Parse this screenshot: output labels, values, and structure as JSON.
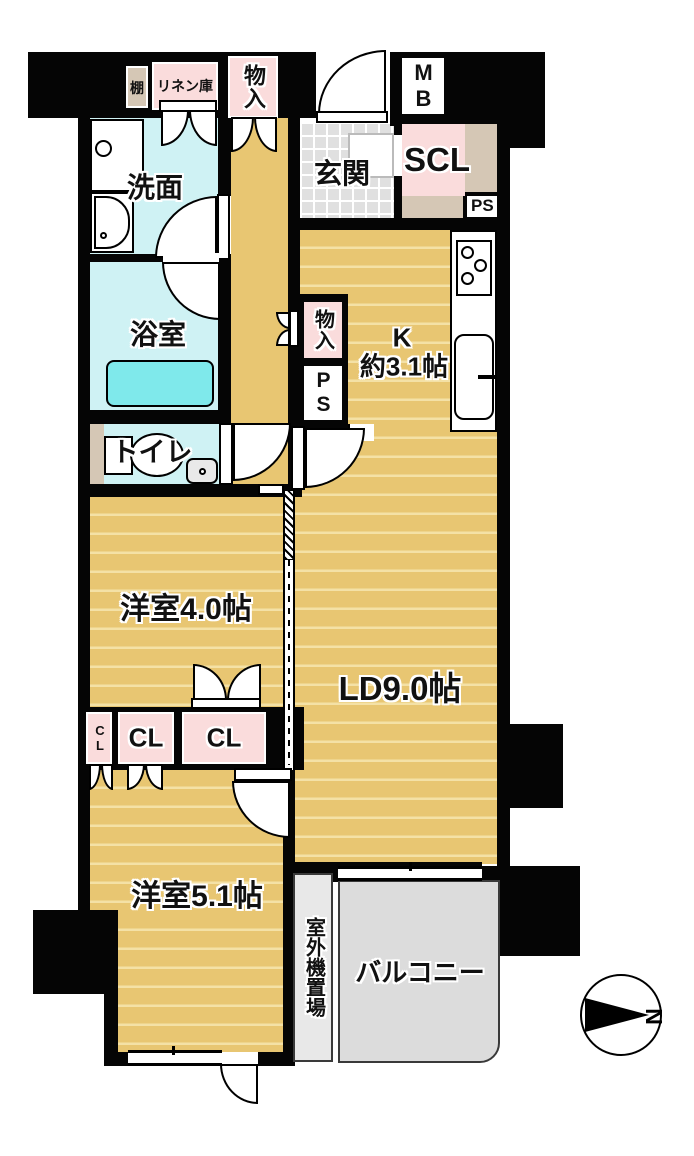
{
  "palette": {
    "wall": "#050505",
    "floor": "#E8C672",
    "floor_stripe": "#F4E1A6",
    "wet": "#CFF2F4",
    "tub": "#7FE9EB",
    "closet_pink": "#FADCDC",
    "beige": "#D5C7B5",
    "tile": "#E0E0E0",
    "balcony": "#DCDCDC",
    "outdoor": "#E8E8E8"
  },
  "rooms": {
    "washroom": {
      "label": "洗面"
    },
    "bathroom": {
      "label": "浴室"
    },
    "toilet": {
      "label": "トイレ"
    },
    "entrance": {
      "label": "玄関"
    },
    "shoe_closet": {
      "label": "SCL"
    },
    "kitchen": {
      "label_line1": "K",
      "label_line2": "約3.1帖"
    },
    "western_room_4": {
      "label": "洋室4.0帖"
    },
    "living_dining": {
      "label": "LD9.0帖"
    },
    "western_room_5": {
      "label": "洋室5.1帖"
    },
    "balcony": {
      "label": "バルコニー"
    },
    "outdoor_unit": {
      "label": "室外機置場"
    }
  },
  "storage": {
    "shelf": "棚",
    "linen": "リネン庫",
    "storage_top": "物入",
    "storage_hall": "物入",
    "cl_small": "CL",
    "cl_1": "CL",
    "cl_2": "CL"
  },
  "utility": {
    "meter_box": "MB",
    "ps_entrance": "PS",
    "ps_kitchen": "PS"
  },
  "compass": {
    "north": "N"
  }
}
